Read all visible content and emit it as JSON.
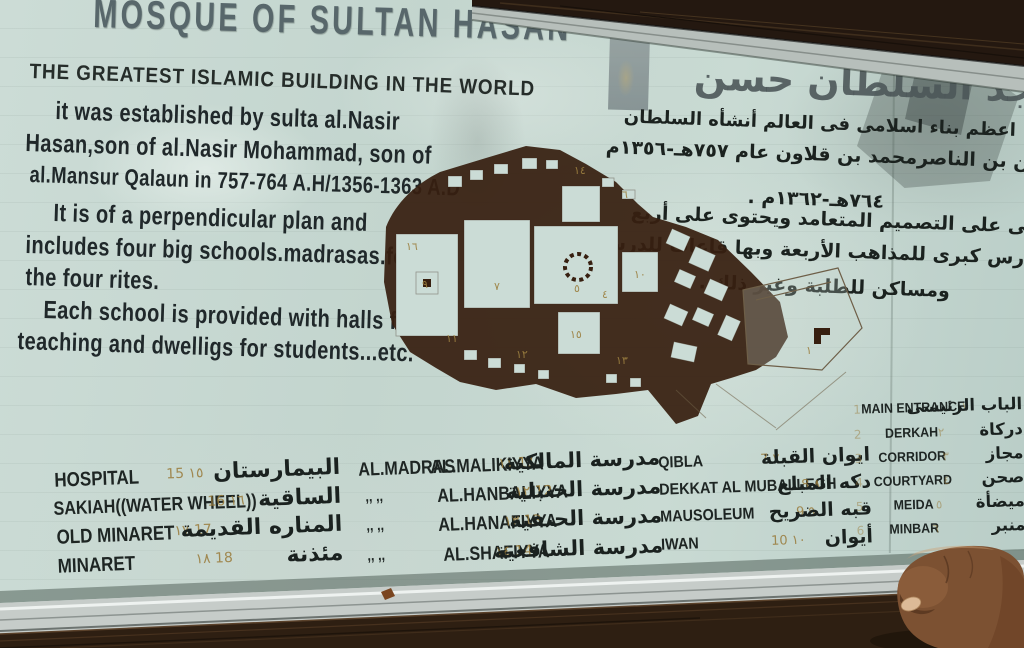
{
  "sign": {
    "title_en": "MOSQUE OF SULTAN HASAN",
    "subtitle_en": "THE GREATEST ISLAMIC BUILDING IN THE WORLD",
    "title_ar": "مسجد السلطان حسن",
    "body_en": [
      "it was established by sulta al.Nasir",
      "Hasan,son of al.Nasir Mohammad, son of",
      "al.Mansur Qalaun in 757-764 A.H/1356-1363 A.D",
      "It is of a perpendicular plan and",
      "includes four big schools.madrasas.for",
      "the four rites.",
      "Each school is provided with halls for",
      "teaching and dwelligs for students...etc."
    ],
    "body_ar": [
      "اعظم بناء اسلامى فى العالم أنشأه السلطان",
      "حسن بن الناصرمحمد بن قلاون عام ٧٥٧هـ-١٣٥٦م",
      "٧٦٤هـ-١٣٦٢م .",
      "بنى على التصميم المتعامد ويحتوى على أربع",
      "مدارس كبرى للمذاهب الأربعة وبها قاعات للدرس",
      "ومساكن للطلبة وغير ذلك ."
    ]
  },
  "legend": {
    "facility": {
      "rows": [
        {
          "en": "HOSPITAL",
          "num": "15 ١٥",
          "ar": "البيمارستان"
        },
        {
          "en": "SAKIAH((WATER WHEEL))",
          "num": "16 ١٦",
          "ar": "الساقية"
        },
        {
          "en": "OLD MINARET",
          "num": "١٧ 17",
          "ar": "المناره القديمة"
        },
        {
          "en": "MINARET",
          "num": "١٨ 18",
          "ar": "مئذنة"
        }
      ]
    },
    "madrasa": {
      "prefix": "AL.MADRAS",
      "ditto": ",,      ,,",
      "rows": [
        {
          "name": "AL.MALIKIYYA",
          "num": "١١ 11",
          "ar": "مدرسة المالكية"
        },
        {
          "name": "AL.HANBALIYYA",
          "num": "١٢ 12",
          "ar": "مدرسة الحنبلية"
        },
        {
          "name": "AL.HANAFIYYA",
          "num": "١٣ 13",
          "ar": "مدرسة الحنفية"
        },
        {
          "name": "AL.SHAFIYYA",
          "num": "١٤ 14",
          "ar": "مدرسة الشافعية"
        }
      ]
    },
    "qibla": {
      "rows": [
        {
          "en": "QIBLA",
          "num": "7 ٧",
          "ar": "ايوان القبلة"
        },
        {
          "en": "DEKKAT AL MUBALLEGH",
          "num": "8 ٨",
          "ar": "دكه المبلغ"
        },
        {
          "en": "MAUSOLEUM",
          "num": "9 ٩",
          "ar": "قبه الضريح"
        },
        {
          "en": "IWAN",
          "num": "10 ١٠",
          "ar": "أيوان"
        }
      ]
    },
    "entrance": {
      "rows": [
        {
          "en": "MAIN ENTRANCE",
          "num_l": "1",
          "num_r": "١",
          "ar": "الباب الرئيسى"
        },
        {
          "en": "DERKAH",
          "num_l": "2",
          "num_r": "٢",
          "ar": "دركاة"
        },
        {
          "en": "CORRIDOR",
          "num_l": "3",
          "num_r": "٣",
          "ar": "مجاز"
        },
        {
          "en": "COURTYARD",
          "num_l": "4",
          "num_r": "٤",
          "ar": "صحن"
        },
        {
          "en": "MEIDA",
          "num_l": "5",
          "num_r": "٥",
          "ar": "ميضأة"
        },
        {
          "en": "MINBAR",
          "num_l": "6",
          "num_r": "٦",
          "ar": "منبر"
        }
      ]
    }
  },
  "plan": {
    "numbers": [
      "٩",
      "٧",
      "٥",
      "٤",
      "١٠",
      "١٤",
      "١٥",
      "١١",
      "١٢",
      "١٣",
      "١",
      "٦",
      "١٦"
    ]
  },
  "colors": {
    "board_green": "#c7d9d2",
    "paint_black": "#20282a",
    "title_gray": "#58676b",
    "plan_brown": "#371f10",
    "handwriting_ochre": "#9a7c39",
    "frame_gray": "#b7bfbb",
    "ledge_brown": "#2e1f12",
    "skin": "#7c5132"
  }
}
